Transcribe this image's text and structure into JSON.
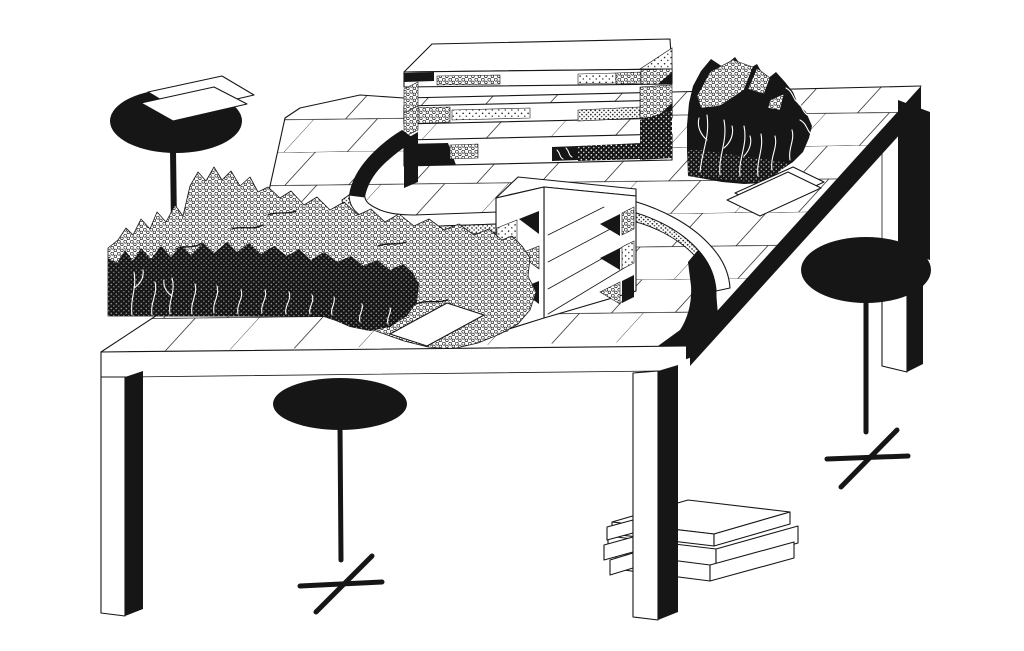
{
  "artwork": {
    "background_color": "#ffffff",
    "ink_color": "#161616",
    "paper_color": "#ffffff",
    "style": "black-and-white isometric ink illustration"
  },
  "labels": {
    "scene": "Ink drawing of a miniature landscape arranged on a tiled table",
    "table": "Large tiled table",
    "table_edge": "Black right edge of tabletop",
    "left_mountain": "Stippled mountain range with dark veined base",
    "slab_building": "Long layered slab structure with textured bands",
    "small_building": "Small layered structure with triangular textures",
    "curved_road": "Curved elevated roadway with U-turn",
    "rock": "Black veined rock formation",
    "stool_left": "Pedestal stool with two paper sheets on top",
    "stool_center": "Pedestal stool standing under the table",
    "stool_right": "Pedestal stool beside the table",
    "papers_near_rock": "Two loose paper sheets on the tabletop",
    "paper_front": "Loose paper sheet near the table front edge",
    "board_stack": "Stack of flat boards on the floor under the table"
  }
}
